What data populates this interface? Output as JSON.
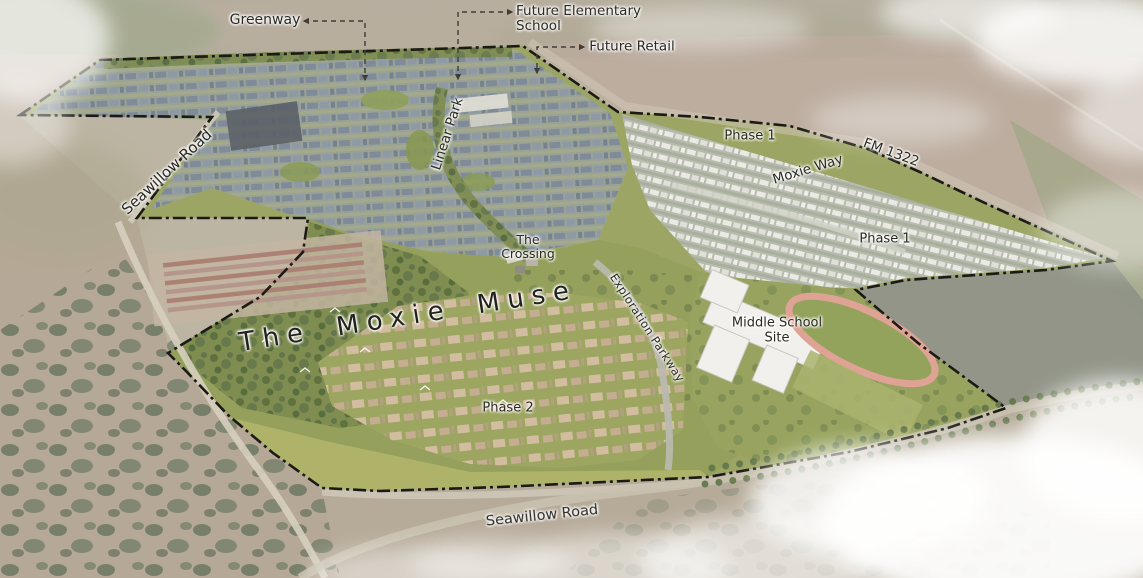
{
  "site": {
    "name": "The Moxie Muse"
  },
  "callouts": {
    "greenway": "Greenway",
    "future_elementary_school": "Future Elementary School",
    "future_retail": "Future Retail"
  },
  "road_labels": {
    "seawillow_road_west": "Seawillow Road",
    "seawillow_road_south": "Seawillow Road",
    "fm_1322": "FM 1322",
    "moxie_way": "Moxie Way",
    "exploration_parkway": "Exploration Parkway"
  },
  "area_labels": {
    "linear_park": "Linear Park",
    "phase_1_north": "Phase 1",
    "phase_1_east": "Phase 1",
    "phase_2": "Phase 2",
    "the_crossing": "The Crossing",
    "middle_school_site": "Middle School Site"
  },
  "colors": {
    "boundary_line": "#1b1a15",
    "label_text": "#2b2a23",
    "running_track": "#dfa395",
    "open_space_green": "#93a05a",
    "forest_green": "#6d7e4b",
    "north_rooftops": "#8692a0",
    "east_rooftops": "#e9eae4",
    "south_rooftops": "#d3bda1",
    "cloud_white": "#ffffff"
  }
}
